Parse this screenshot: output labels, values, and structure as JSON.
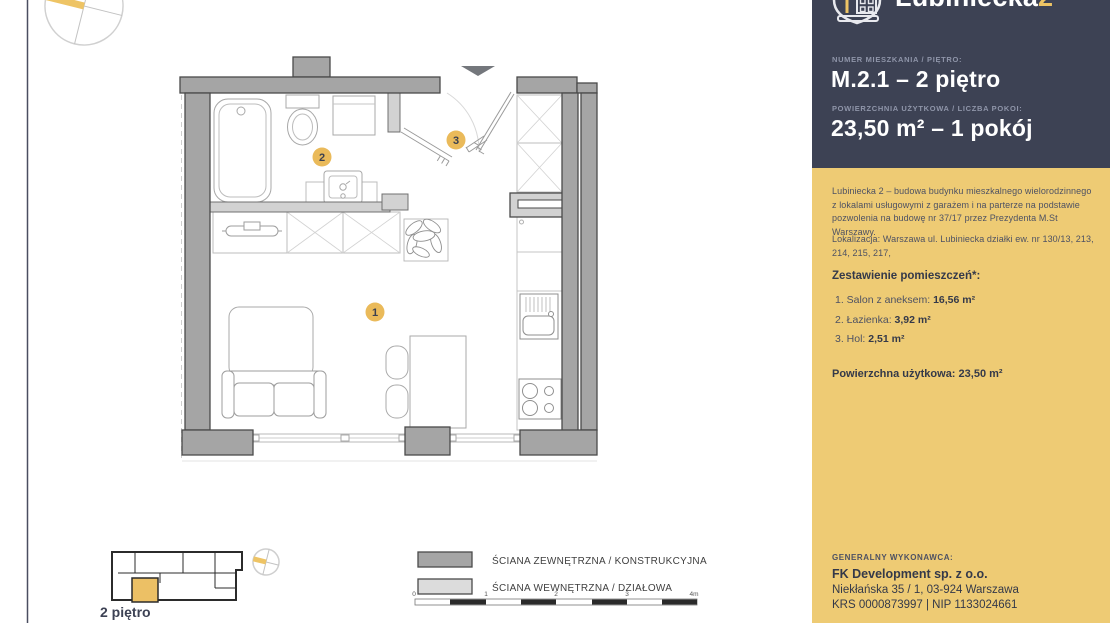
{
  "panel": {
    "brand": {
      "name": "Lubiniecka",
      "suffix": "2"
    },
    "apartment": {
      "number_label": "NUMER MIESZKANIA / PIĘTRO:",
      "number_value": "M.2.1 – 2 piętro",
      "area_label": "POWIERZCHNIA UŻYTKOWA / LICZBA POKOI:",
      "area_value": "23,50 m² – 1 pokój"
    },
    "description": "Lubiniecka 2 – budowa budynku mieszkalnego wielorodzinnego z lokalami usługowymi z garażem i na parterze na podstawie pozwolenia na budowę nr 37/17 przez Prezydenta M.St Warszawy.",
    "location": "Lokalizacja: Warszawa ul. Lubiniecka działki ew. nr 130/13, 213, 214, 215, 217,",
    "rooms": {
      "heading": "Zestawienie pomieszczeń*:",
      "items": [
        {
          "label": "1. Salon z aneksem:",
          "area": "16,56 m²"
        },
        {
          "label": "2. Łazienka:",
          "area": "3,92 m²"
        },
        {
          "label": "3. Hol:",
          "area": "2,51 m²"
        }
      ],
      "total_label": "Powierzchna użytkowa:",
      "total_value": "23,50 m²"
    },
    "contractor": {
      "label": "GENERALNY WYKONAWCA:",
      "name": "FK Development sp. z o.o.",
      "address": "Niekłańska 35 / 1, 03-924 Warszawa",
      "ids": "KRS 0000873997 | NIP 1133024661"
    }
  },
  "plan": {
    "markers": [
      "1",
      "2",
      "3"
    ],
    "floor_label": "2 piętro",
    "legend": {
      "external": "ŚCIANA ZEWNĘTRZNA / KONSTRUKCYJNA",
      "internal": "ŚCIANA WEWNĘTRZNA / DZIAŁOWA"
    },
    "scale_ticks": [
      "0",
      "1",
      "2",
      "3",
      "4m"
    ]
  },
  "colors": {
    "navy": "#3d4254",
    "panel_yellow": "#eecb74",
    "marker_yellow": "#eaba5a",
    "wall_external": "#a5a5a5",
    "wall_internal": "#d2d2d2"
  }
}
